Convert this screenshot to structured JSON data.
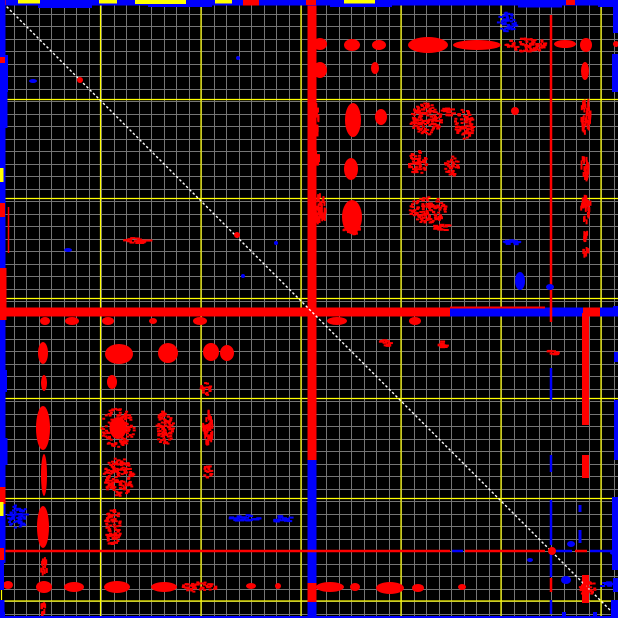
{
  "chart_data": {
    "type": "heatmap",
    "title": "",
    "description": "2D difference correlation map on black background: fine gray grid with yellow major gridlines, white dashed unity diagonal, red (positive) and blue (negative) spots arranged roughly symmetrically about the diagonal, strong red/blue cross bands near the center, and blue borders along the image edges.",
    "canvas": {
      "width": 618,
      "height": 618,
      "background": "#000000"
    },
    "colors": {
      "background": "#000000",
      "grid_minor": "#757575",
      "grid_major": "#ffff00",
      "diagonal": "#ffffff",
      "positive": "#ff0000",
      "negative": "#0000fe"
    },
    "grid": {
      "minor_spacing": 12.5,
      "minor_offset": 1,
      "major_x": [
        1.5,
        100.5,
        201,
        301,
        401,
        501,
        601
      ],
      "major_y": [
        1.5,
        99.5,
        198.5,
        298.5,
        398.5,
        498.5,
        601
      ]
    },
    "diagonal": {
      "x1": 0,
      "y1": 0,
      "x2": 618,
      "y2": 618,
      "dash": "2.5 2.2",
      "width": 1.4
    },
    "bands": [
      {
        "orient": "v",
        "pos": 312,
        "w": 9,
        "segments": [
          [
            0,
            460,
            "r"
          ],
          [
            460,
            583,
            "b"
          ],
          [
            583,
            602,
            "r"
          ],
          [
            602,
            618,
            "b"
          ]
        ]
      },
      {
        "orient": "h",
        "pos": 312,
        "w": 9,
        "segments": [
          [
            0,
            450,
            "r"
          ],
          [
            450,
            618,
            "b"
          ]
        ]
      }
    ],
    "lines": [
      {
        "orient": "h",
        "pos": 312,
        "w": 9,
        "segments": [
          [
            583,
            600,
            "r"
          ]
        ]
      },
      {
        "orient": "h",
        "pos": 307.5,
        "w": 2,
        "segments": [
          [
            450,
            545,
            "r"
          ]
        ]
      },
      {
        "orient": "v",
        "pos": 551,
        "w": 2.5,
        "segments": [
          [
            15,
            322,
            "r"
          ],
          [
            368,
            400,
            "b"
          ],
          [
            455,
            472,
            "b"
          ],
          [
            500,
            545,
            "b"
          ],
          [
            553,
            577,
            "b"
          ],
          [
            578,
            592,
            "r"
          ],
          [
            600,
            614,
            "b"
          ]
        ]
      },
      {
        "orient": "h",
        "pos": 551,
        "w": 2.5,
        "segments": [
          [
            0,
            450,
            "r"
          ],
          [
            452,
            463,
            "b"
          ],
          [
            465,
            545,
            "r"
          ],
          [
            553,
            572,
            "b"
          ],
          [
            575,
            587,
            "r"
          ],
          [
            590,
            612,
            "b"
          ]
        ]
      },
      {
        "orient": "v",
        "pos": 585.5,
        "w": 7,
        "segments": [
          [
            313,
            425,
            "r"
          ],
          [
            455,
            478,
            "r"
          ],
          [
            575,
            603,
            "r"
          ]
        ]
      },
      {
        "orient": "v",
        "pos": 580,
        "w": 3,
        "segments": [
          [
            505,
            512,
            "b"
          ],
          [
            530,
            543,
            "b"
          ]
        ]
      },
      {
        "orient": "v",
        "pos": 8.5,
        "w": 1.5,
        "segments": [
          [
            207,
            253,
            "r"
          ]
        ]
      }
    ],
    "edges": [
      {
        "side": "top",
        "segments": [
          [
            0,
            618,
            5.5,
            "b"
          ],
          [
            38,
            92,
            8,
            "b"
          ],
          [
            148,
            212,
            7,
            "b"
          ],
          [
            330,
            392,
            7,
            "b"
          ],
          [
            518,
            562,
            7.5,
            "b"
          ],
          [
            598,
            618,
            7,
            "b"
          ],
          [
            0,
            6,
            5,
            "r"
          ],
          [
            243,
            259,
            5.5,
            "r"
          ],
          [
            306,
            316,
            5,
            "r"
          ],
          [
            566,
            575,
            5,
            "r"
          ],
          [
            18,
            40,
            3.5,
            "y"
          ],
          [
            99,
            117,
            3.5,
            "y"
          ],
          [
            135,
            186,
            4,
            "y"
          ],
          [
            215,
            232,
            3.5,
            "y"
          ],
          [
            344,
            375,
            3.5,
            "y"
          ]
        ]
      },
      {
        "side": "left",
        "segments": [
          [
            0,
            563,
            5.5,
            "b"
          ],
          [
            55,
            92,
            8,
            "b"
          ],
          [
            88,
            128,
            7.5,
            "b"
          ],
          [
            370,
            392,
            7,
            "b"
          ],
          [
            438,
            465,
            7.5,
            "b"
          ],
          [
            560,
            590,
            4,
            "b"
          ],
          [
            600,
            618,
            4.5,
            "b"
          ],
          [
            57,
            63,
            5,
            "r"
          ],
          [
            203,
            217,
            5,
            "r"
          ],
          [
            268,
            320,
            6.5,
            "r"
          ],
          [
            487,
            504,
            5.5,
            "r"
          ],
          [
            548,
            560,
            4,
            "r"
          ],
          [
            168,
            182,
            3.5,
            "y"
          ],
          [
            502,
            516,
            3.5,
            "y"
          ]
        ]
      },
      {
        "side": "right",
        "segments": [
          [
            0,
            33,
            5,
            "b"
          ],
          [
            54,
            92,
            6,
            "b"
          ],
          [
            306,
            316,
            5,
            "b"
          ],
          [
            352,
            362,
            4,
            "b"
          ],
          [
            400,
            460,
            4,
            "b"
          ],
          [
            497,
            570,
            6,
            "b"
          ],
          [
            578,
            592,
            5,
            "b"
          ],
          [
            600,
            618,
            7,
            "b"
          ],
          [
            43,
            46,
            4,
            "r"
          ]
        ]
      },
      {
        "side": "bottom",
        "segments": [
          [
            0,
            618,
            2,
            "b"
          ],
          [
            0,
            5,
            6,
            "b"
          ],
          [
            309,
            316,
            6,
            "b"
          ],
          [
            562,
            566,
            6,
            "b"
          ],
          [
            593,
            597,
            6,
            "b"
          ],
          [
            612,
            618,
            6,
            "b"
          ]
        ]
      }
    ],
    "spots": [
      [
        352,
        45,
        8,
        6,
        "r",
        "solid"
      ],
      [
        379,
        45,
        7,
        5,
        "r",
        "solid"
      ],
      [
        428,
        45,
        20,
        8,
        "r",
        "solid"
      ],
      [
        477,
        45,
        24,
        5,
        "r",
        "solid"
      ],
      [
        527,
        45,
        21,
        7,
        "r",
        "dots"
      ],
      [
        565,
        44,
        11,
        4,
        "r",
        "solid"
      ],
      [
        586,
        45,
        6,
        7,
        "r",
        "solid"
      ],
      [
        616,
        44,
        3,
        3,
        "r",
        "solid"
      ],
      [
        320,
        44,
        7,
        6,
        "r",
        "solid"
      ],
      [
        320,
        70,
        7,
        8,
        "r",
        "solid"
      ],
      [
        375,
        68,
        4,
        6,
        "r",
        "solid"
      ],
      [
        585,
        71,
        4,
        9,
        "r",
        "solid"
      ],
      [
        353,
        120,
        8,
        17,
        "r",
        "solid"
      ],
      [
        381,
        117,
        6,
        8,
        "r",
        "solid"
      ],
      [
        426,
        119,
        16,
        16,
        "r",
        "dots"
      ],
      [
        448,
        112,
        6,
        4,
        "r",
        "hdash"
      ],
      [
        465,
        124,
        10,
        15,
        "r",
        "dots"
      ],
      [
        515,
        111,
        4,
        4,
        "r",
        "solid"
      ],
      [
        586,
        116,
        5,
        17,
        "r",
        "vdash"
      ],
      [
        316,
        121,
        3,
        17,
        "r",
        "vdash"
      ],
      [
        351,
        169,
        7,
        11,
        "r",
        "solid"
      ],
      [
        418,
        163,
        9,
        12,
        "r",
        "dots"
      ],
      [
        452,
        166,
        7,
        10,
        "r",
        "dots"
      ],
      [
        585,
        168,
        4,
        12,
        "r",
        "vdash"
      ],
      [
        317,
        158,
        3,
        7,
        "r",
        "vdash"
      ],
      [
        352,
        217,
        10,
        17,
        "r",
        "solid"
      ],
      [
        352,
        230,
        8,
        5,
        "r",
        "dots"
      ],
      [
        428,
        210,
        19,
        13,
        "r",
        "dots"
      ],
      [
        320,
        210,
        6,
        15,
        "r",
        "vdash"
      ],
      [
        586,
        209,
        5,
        13,
        "r",
        "vdash"
      ],
      [
        442,
        227,
        8,
        4,
        "r",
        "hdash"
      ],
      [
        586,
        237,
        3,
        5,
        "r",
        "vdash"
      ],
      [
        508,
        22,
        10,
        10,
        "b",
        "dots"
      ],
      [
        512,
        243,
        9,
        3,
        "b",
        "hdash"
      ],
      [
        520,
        281,
        5,
        9,
        "b",
        "solid"
      ],
      [
        550,
        287,
        4,
        3,
        "b",
        "solid"
      ],
      [
        586,
        252,
        3,
        4,
        "r",
        "vdash"
      ],
      [
        80,
        80,
        3,
        3,
        "r",
        "solid"
      ],
      [
        237,
        235,
        3,
        3,
        "r",
        "solid"
      ],
      [
        137,
        241,
        14,
        3,
        "r",
        "hdash"
      ],
      [
        276,
        243,
        2,
        2,
        "b",
        "solid"
      ],
      [
        243,
        276,
        2,
        2,
        "b",
        "solid"
      ],
      [
        68,
        250,
        4,
        2,
        "b",
        "solid"
      ],
      [
        238,
        58,
        2,
        2,
        "b",
        "solid"
      ],
      [
        33,
        81,
        4,
        2,
        "b",
        "solid"
      ],
      [
        45,
        321,
        5,
        4,
        "r",
        "solid"
      ],
      [
        72,
        321,
        7,
        4,
        "r",
        "solid"
      ],
      [
        108,
        321,
        6,
        4,
        "r",
        "solid"
      ],
      [
        153,
        321,
        4,
        3,
        "r",
        "solid"
      ],
      [
        200,
        321,
        7,
        4,
        "r",
        "solid"
      ],
      [
        43,
        353,
        5,
        11,
        "r",
        "solid"
      ],
      [
        119,
        354,
        14,
        10,
        "r",
        "solid"
      ],
      [
        168,
        353,
        10,
        10,
        "r",
        "solid"
      ],
      [
        211,
        352,
        8,
        9,
        "r",
        "solid"
      ],
      [
        227,
        353,
        7,
        8,
        "r",
        "solid"
      ],
      [
        44,
        383,
        3,
        8,
        "r",
        "solid"
      ],
      [
        112,
        382,
        5,
        7,
        "r",
        "solid"
      ],
      [
        206,
        389,
        5,
        7,
        "r",
        "dots"
      ],
      [
        43,
        428,
        7,
        22,
        "r",
        "solid"
      ],
      [
        118,
        428,
        14,
        17,
        "r",
        "halo"
      ],
      [
        165,
        428,
        9,
        17,
        "r",
        "dots"
      ],
      [
        208,
        428,
        5,
        16,
        "r",
        "vdash"
      ],
      [
        44,
        475,
        3,
        21,
        "r",
        "solid"
      ],
      [
        119,
        477,
        15,
        19,
        "r",
        "dots"
      ],
      [
        208,
        472,
        4,
        8,
        "r",
        "dots"
      ],
      [
        43,
        527,
        6,
        21,
        "r",
        "solid"
      ],
      [
        113,
        527,
        8,
        19,
        "r",
        "dots"
      ],
      [
        18,
        517,
        10,
        12,
        "b",
        "dots"
      ],
      [
        245,
        518,
        17,
        3,
        "b",
        "hdash"
      ],
      [
        283,
        519,
        11,
        3,
        "b",
        "hdash"
      ],
      [
        44,
        568,
        3,
        9,
        "r",
        "vdash"
      ],
      [
        8,
        585,
        5,
        4,
        "r",
        "solid"
      ],
      [
        44,
        587,
        8,
        6,
        "r",
        "solid"
      ],
      [
        74,
        587,
        10,
        5,
        "r",
        "solid"
      ],
      [
        117,
        587,
        13,
        6,
        "r",
        "solid"
      ],
      [
        164,
        587,
        13,
        5,
        "r",
        "solid"
      ],
      [
        200,
        587,
        18,
        5,
        "r",
        "dots"
      ],
      [
        251,
        586,
        5,
        3,
        "r",
        "solid"
      ],
      [
        278,
        586,
        3,
        3,
        "r",
        "solid"
      ],
      [
        43,
        610,
        3,
        6,
        "r",
        "vdash"
      ],
      [
        337,
        321,
        10,
        4,
        "r",
        "solid"
      ],
      [
        415,
        321,
        6,
        4,
        "r",
        "solid"
      ],
      [
        386,
        343,
        5,
        4,
        "r",
        "hdash"
      ],
      [
        444,
        344,
        5,
        4,
        "r",
        "hdash"
      ],
      [
        554,
        352,
        5,
        3,
        "r",
        "hdash"
      ],
      [
        330,
        587,
        14,
        5,
        "r",
        "solid"
      ],
      [
        355,
        587,
        5,
        4,
        "r",
        "solid"
      ],
      [
        390,
        588,
        14,
        6,
        "r",
        "solid"
      ],
      [
        418,
        588,
        6,
        4,
        "r",
        "solid"
      ],
      [
        462,
        587,
        4,
        3,
        "r",
        "solid"
      ],
      [
        588,
        588,
        8,
        8,
        "r",
        "dots"
      ],
      [
        566,
        580,
        5,
        4,
        "b",
        "solid"
      ],
      [
        608,
        585,
        6,
        3,
        "b",
        "hdash"
      ],
      [
        552,
        551,
        4,
        4,
        "r",
        "solid"
      ],
      [
        530,
        560,
        3,
        2,
        "b",
        "solid"
      ],
      [
        614,
        553,
        4,
        2,
        "b",
        "solid"
      ],
      [
        571,
        544,
        4,
        3,
        "b",
        "solid"
      ]
    ]
  }
}
